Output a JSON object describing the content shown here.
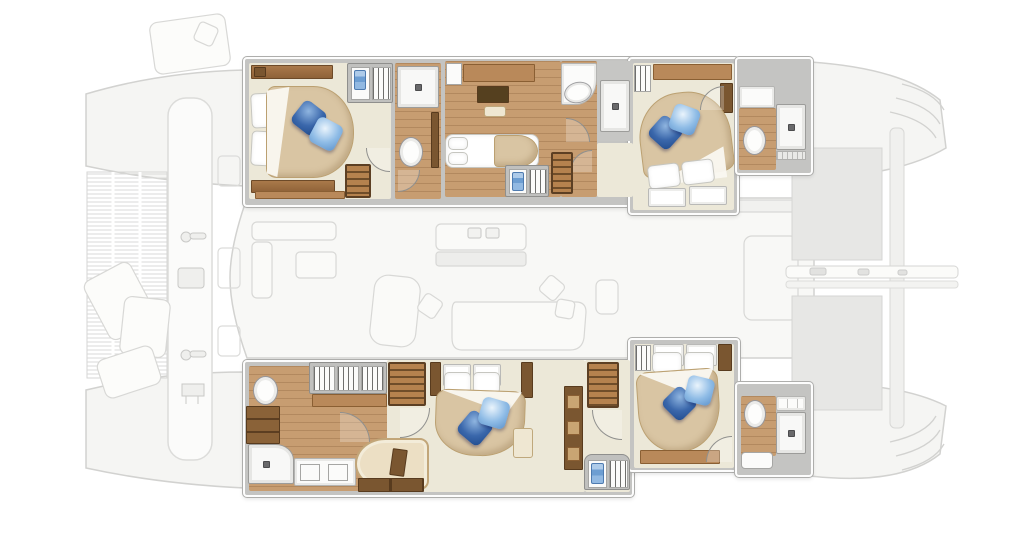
{
  "diagram": {
    "type": "yacht-interior-floor-plan",
    "subject": "Sailing catamaran lower-deck accommodation plan, bow at left, highlighted cabins over a faded main-deck plan",
    "aria": {
      "scene": "Catamaran interior floor plan with five cabins and en-suite bathrooms",
      "deck_ghost": "Faded main-deck plan: bow trampoline, forward crossbeam, sun pads, saloon with galley island and dinette, cockpit, tender platform and transom steps",
      "port_hull": "Port hull accommodations (top strip)",
      "starboard_hull": "Starboard hull accommodations (bottom strip)"
    },
    "rooms": {
      "cabin_fwd_port": "Forward port guest cabin: double bed with two blue accent pillows, headboard lockers, towel locker, entry steps",
      "bath_fwd_port": "Forward port en-suite: shower, toilet, vanity",
      "cabin_mid_port": "Midship port cabin: double berth, desk with TV panel and stool",
      "bath_mid_port": "Midship port en-suite: washbasin on curved counter, separate shower, companionway steps",
      "cabin_aft_port": "Aft port guest cabin: angled double bed with two blue accent pillows, hanging locker, hull windows",
      "bath_aft_port": "Aft port en-suite: shower, toilet, counter",
      "owner_bathroom": "Owner's bathroom and dressing: toilet, shower, twin washbasins, triple wardrobe, drawer chest",
      "owner_cabin": "Owner's suite: island double bed with two blue accent pillows, sofa with stowage base, shelving, companionway steps",
      "mid_landing": "Starboard landing: companionway steps, towel and hanging lockers",
      "cabin_aft_stbd": "Aft starboard guest cabin: double bed with two blue accent pillows, hanging locker, bench",
      "bath_aft_stbd": "Aft starboard en-suite: shower, toilet, counter, bench"
    },
    "deck_features": {
      "trampoline": "Bow trampoline net",
      "crossbeam": "Forward crossbeam with cleats and anchor rollers",
      "sun_pads": "Foredeck sun pads",
      "saloon": "Saloon with galley island, dinette table, lounge sofa and chaise",
      "cockpit": "Aft cockpit with table",
      "platform": "Tender / swim platform between sterns",
      "aft_beam": "Aft crossbeam with mainsheet traveller",
      "transom_steps": "Transom boarding steps"
    },
    "palette": {
      "wall": "#c4c4c2",
      "wall_edge": "#ffffff",
      "floor_beige": "#ece8d8",
      "floor_wood": "#c79d71",
      "furniture_wood_mid": "#b9895a",
      "furniture_wood_dark": "#7a5630",
      "duvet_tan": "#d9c5a3",
      "linen_white": "#ffffff",
      "pillow_dark_blue": "#2d5da3",
      "pillow_light_blue": "#8fbce6",
      "towel_blue": "#7aa7d8",
      "fixture_white": "#f8f8f7",
      "fixture_edge": "#9c9c9a",
      "ghost_fill": "#f4f4f2",
      "ghost_line": "#d4d4d2"
    }
  }
}
